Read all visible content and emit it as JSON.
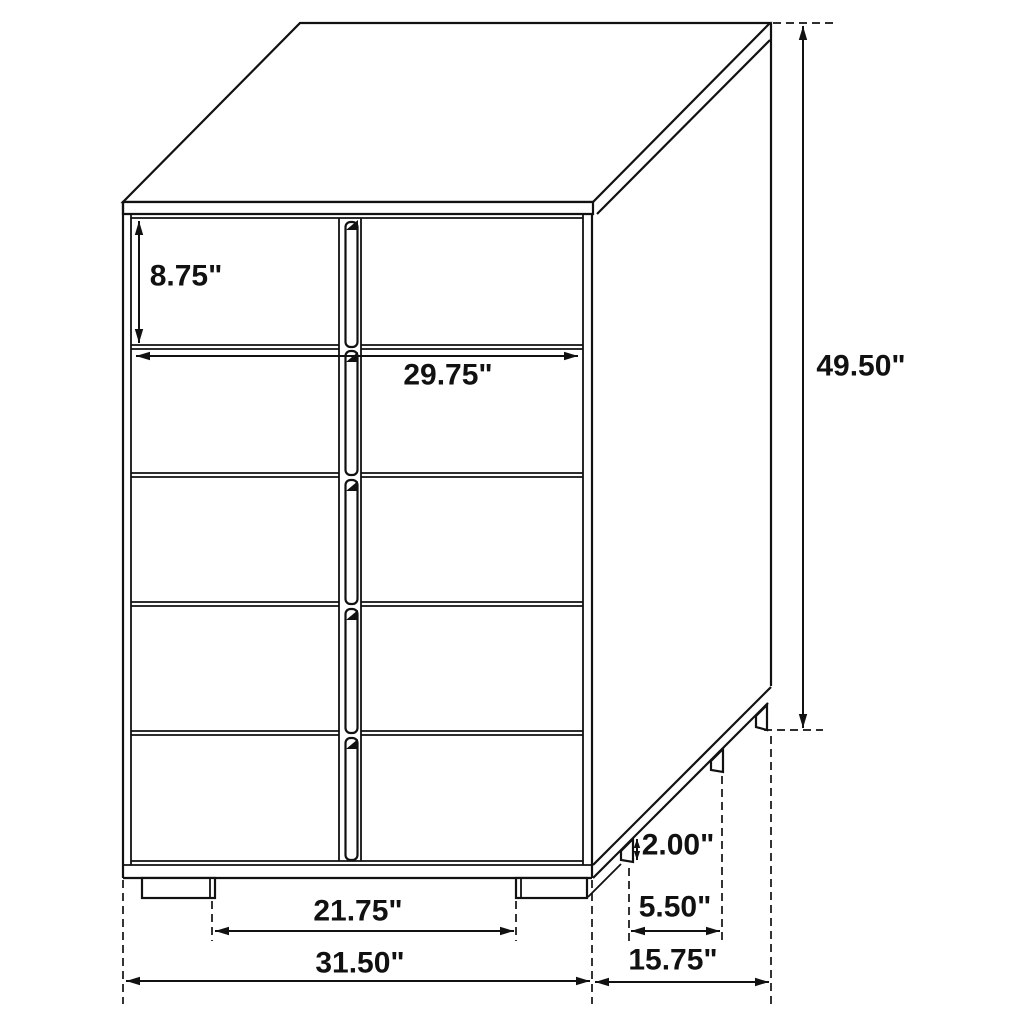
{
  "diagram": {
    "title": "Five-drawer chest dimension diagram",
    "view": "three-quarter line drawing",
    "units": "inches"
  },
  "dimensions": {
    "drawer_height": "8.75\"",
    "drawer_width": "29.75\"",
    "overall_height": "49.50\"",
    "base_height": "2.00\"",
    "foot_inset_depth": "5.50\"",
    "foot_span": "21.75\"",
    "overall_width": "31.50\"",
    "overall_depth": "15.75\""
  },
  "colors": {
    "line": "#111111",
    "background": "#ffffff"
  }
}
